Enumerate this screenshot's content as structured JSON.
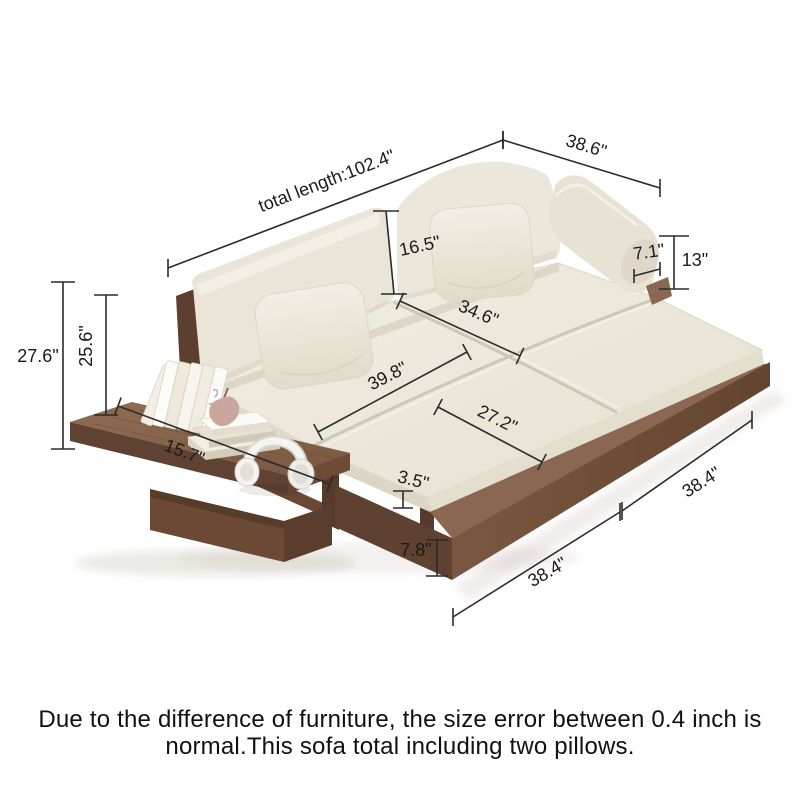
{
  "note": {
    "line1": "Due to the difference of furniture, the size error between 0.4 inch is",
    "line2": "normal.This sofa total including two pillows."
  },
  "style": {
    "background": "#ffffff",
    "dim_line_color": "#2b2b2b",
    "dim_text_color": "#1a1a1a",
    "dim_font_size": 18,
    "note_font_size": 24,
    "colors": {
      "wood_top": "#8a6750",
      "wood_front": "#6b4936",
      "wood_dark": "#5e4130",
      "cushion": "#ece7db",
      "cushion_shadow": "#d8d0bd",
      "pillow": "#f0ebdf",
      "ornament_pink": "#c9a79c",
      "headphones_white": "#f5f4f0"
    }
  },
  "dimensions": [
    {
      "id": "total-length",
      "label": "total length:102.4\"",
      "x1": 168,
      "y1": 268,
      "x2": 503,
      "y2": 140,
      "lx": 327,
      "ly": 182,
      "rot": -21,
      "tick": "v",
      "tickHalf": 9
    },
    {
      "id": "depth-38-6",
      "label": "38.6\"",
      "x1": 503,
      "y1": 140,
      "x2": 660,
      "y2": 188,
      "lx": 586,
      "ly": 147,
      "rot": 17,
      "tick": "v",
      "tickHalf": 9
    },
    {
      "id": "back-height-16-5",
      "label": "16.5\"",
      "x1": 386,
      "y1": 211,
      "x2": 394,
      "y2": 294,
      "lx": 420,
      "ly": 247,
      "rot": -12,
      "tick": "h",
      "tickHalf": 13
    },
    {
      "id": "armrest-width-7-1",
      "label": "7.1\"",
      "x1": 634,
      "y1": 276,
      "x2": 660,
      "y2": 269,
      "lx": 649,
      "ly": 253,
      "rot": -8,
      "tick": "v",
      "tickHalf": 7
    },
    {
      "id": "armrest-height-13",
      "label": "13\"",
      "x1": 674,
      "y1": 236,
      "x2": 674,
      "y2": 289,
      "lx": 695,
      "ly": 261,
      "rot": 0,
      "tick": "h",
      "tickHalf": 15
    },
    {
      "id": "seat-depth-34-6",
      "label": "34.6\"",
      "x1": 400,
      "y1": 301,
      "x2": 520,
      "y2": 356,
      "lx": 478,
      "ly": 314,
      "rot": 23,
      "tick": "p",
      "tickHalf": 9
    },
    {
      "id": "seat-width-39-8",
      "label": "39.8\"",
      "x1": 318,
      "y1": 432,
      "x2": 467,
      "y2": 352,
      "lx": 388,
      "ly": 377,
      "rot": -27,
      "tick": "p",
      "tickHalf": 9
    },
    {
      "id": "ottoman-depth-27-2",
      "label": "27.2\"",
      "x1": 438,
      "y1": 407,
      "x2": 542,
      "y2": 462,
      "lx": 497,
      "ly": 420,
      "rot": 26,
      "tick": "p",
      "tickHalf": 9
    },
    {
      "id": "total-height-27-6",
      "label": "27.6\"",
      "x1": 63,
      "y1": 282,
      "x2": 63,
      "y2": 449,
      "lx": 38,
      "ly": 357,
      "rot": 0,
      "tick": "h",
      "tickHalf": 12
    },
    {
      "id": "back-height-25-6",
      "label": "25.6\"",
      "x1": 106,
      "y1": 295,
      "x2": 106,
      "y2": 415,
      "lx": 87,
      "ly": 346,
      "rot": -90,
      "tick": "h",
      "tickHalf": 12
    },
    {
      "id": "table-depth-15-7",
      "label": "15.7\"",
      "x1": 118,
      "y1": 406,
      "x2": 330,
      "y2": 484,
      "lx": 184,
      "ly": 453,
      "rot": 21,
      "tick": "p",
      "tickHalf": 9
    },
    {
      "id": "cushion-thick-3-5",
      "label": "3.5\"",
      "x1": 403,
      "y1": 491,
      "x2": 403,
      "y2": 508,
      "lx": 413,
      "ly": 481,
      "rot": 14,
      "tick": "h",
      "tickHalf": 10
    },
    {
      "id": "base-height-7-8",
      "label": "7.8\"",
      "x1": 437,
      "y1": 540,
      "x2": 437,
      "y2": 576,
      "lx": 416,
      "ly": 551,
      "rot": 0,
      "tick": "h",
      "tickHalf": 11
    },
    {
      "id": "front-width-38-4",
      "label": "38.4\"",
      "x1": 453,
      "y1": 617,
      "x2": 620,
      "y2": 512,
      "lx": 548,
      "ly": 573,
      "rot": -30,
      "tick": "v",
      "tickHalf": 9
    },
    {
      "id": "side-width-38-4",
      "label": "38.4\"",
      "x1": 622,
      "y1": 511,
      "x2": 752,
      "y2": 420,
      "lx": 702,
      "ly": 483,
      "rot": -32,
      "tick": "v",
      "tickHalf": 9
    }
  ]
}
